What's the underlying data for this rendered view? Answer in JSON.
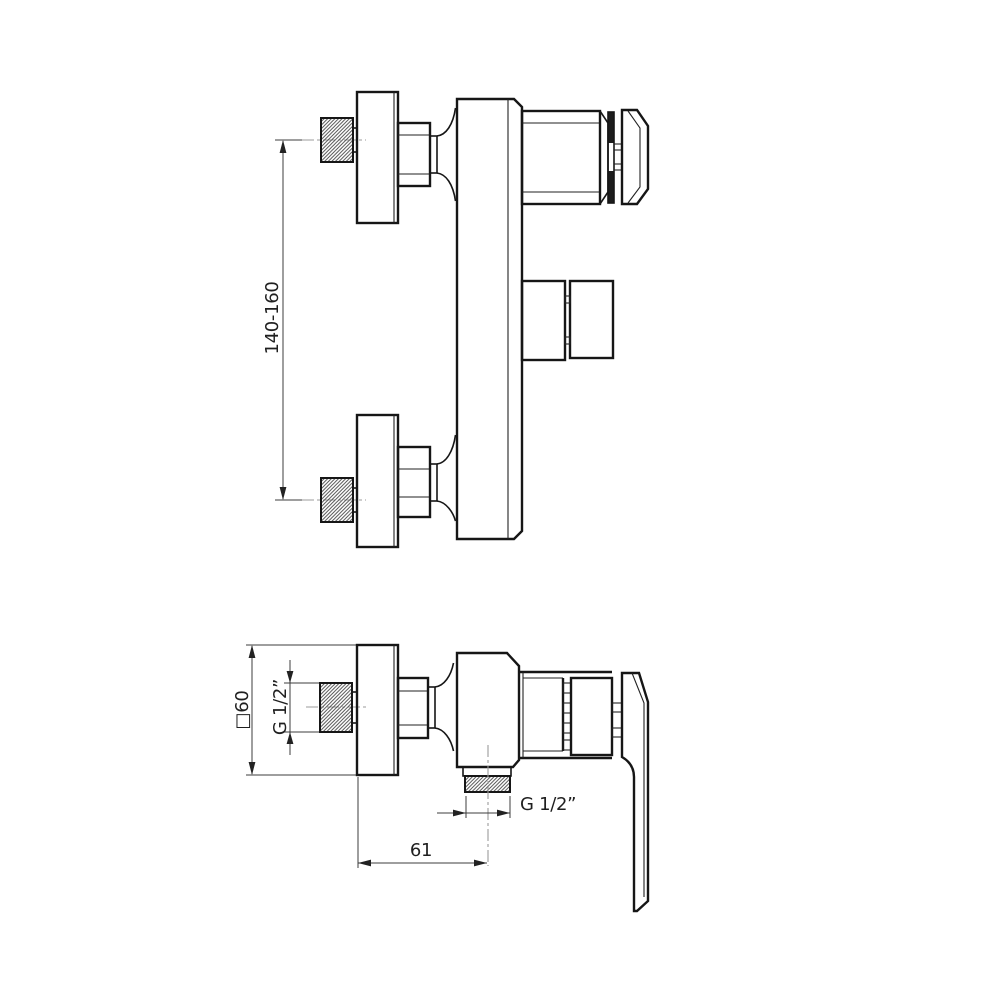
{
  "drawing": {
    "type": "technical-orthographic-diagram",
    "colors": {
      "background": "#ffffff",
      "outline": "#161616",
      "dimension_lines": "#3c3c3c",
      "centerlines": "#9b9b9b",
      "hatching": "#4a4a4a"
    },
    "dimensions": {
      "mounting_distance": "140-160",
      "plate_size": "□60",
      "inlet_thread": "G 1/2”",
      "outlet_thread": "G 1/2”",
      "outlet_offset": "61"
    }
  }
}
